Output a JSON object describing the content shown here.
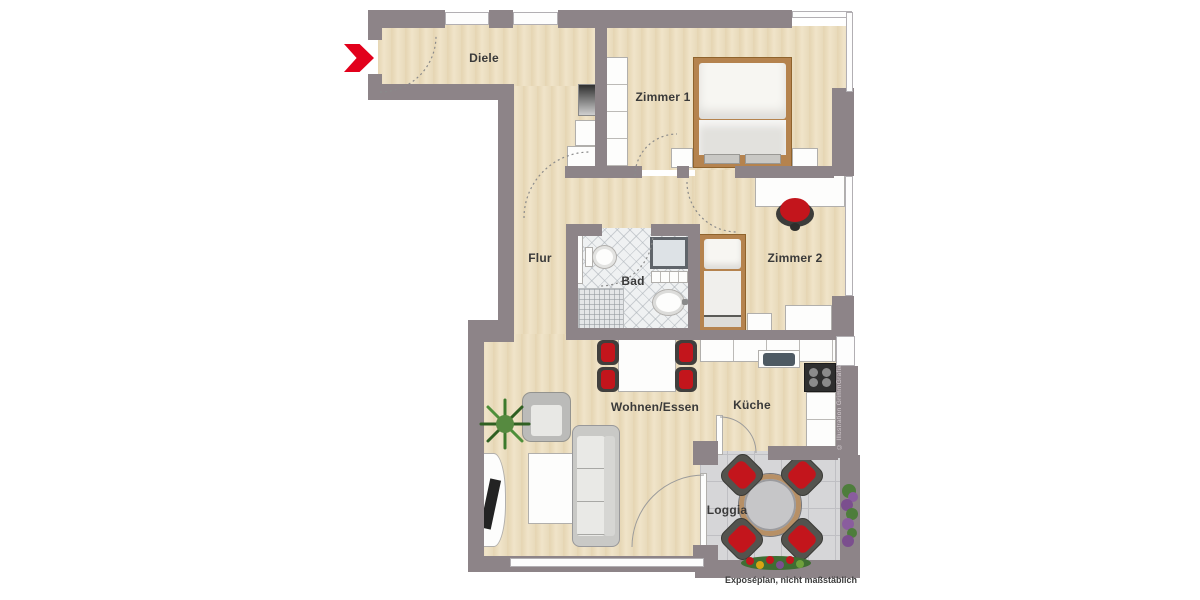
{
  "caption": "Exposéplan, nicht maßstäblich",
  "credit": "© Illustration GrimmGrafik",
  "rooms": {
    "diele": "Diele",
    "zimmer1": "Zimmer 1",
    "zimmer2": "Zimmer 2",
    "flur": "Flur",
    "bad": "Bad",
    "kueche": "Küche",
    "wohnen_essen": "Wohnen/Essen",
    "loggia": "Loggia"
  },
  "colors": {
    "wall": "#8d8488",
    "accent_red": "#e2001b",
    "chair_red": "#c3151c",
    "wood_floor": "#ebdec1",
    "bath_tile": "#eff1f2",
    "loggia_tile": "#d6d6d8",
    "bed_frame": "#b5834e"
  },
  "icons": {
    "entrance": "entrance-arrow"
  },
  "furniture": {
    "zimmer1": [
      "double-bed",
      "nightstands",
      "wardrobe"
    ],
    "zimmer2": [
      "desk",
      "desk-chair",
      "single-bed",
      "side-table",
      "dresser"
    ],
    "bad": [
      "toilet",
      "shower",
      "washbasin",
      "vanity",
      "mosaic-shower-floor",
      "cabinet"
    ],
    "kueche": [
      "counter",
      "sink",
      "stove",
      "side-counter"
    ],
    "wohnen_essen": [
      "dining-table",
      "dining-chairs",
      "sofa",
      "armchair",
      "coffee-table",
      "tv-sideboard",
      "tv",
      "plant"
    ],
    "loggia": [
      "round-table",
      "chairs",
      "planters",
      "flower-box"
    ],
    "diele": [
      "mirror",
      "cabinets"
    ]
  }
}
